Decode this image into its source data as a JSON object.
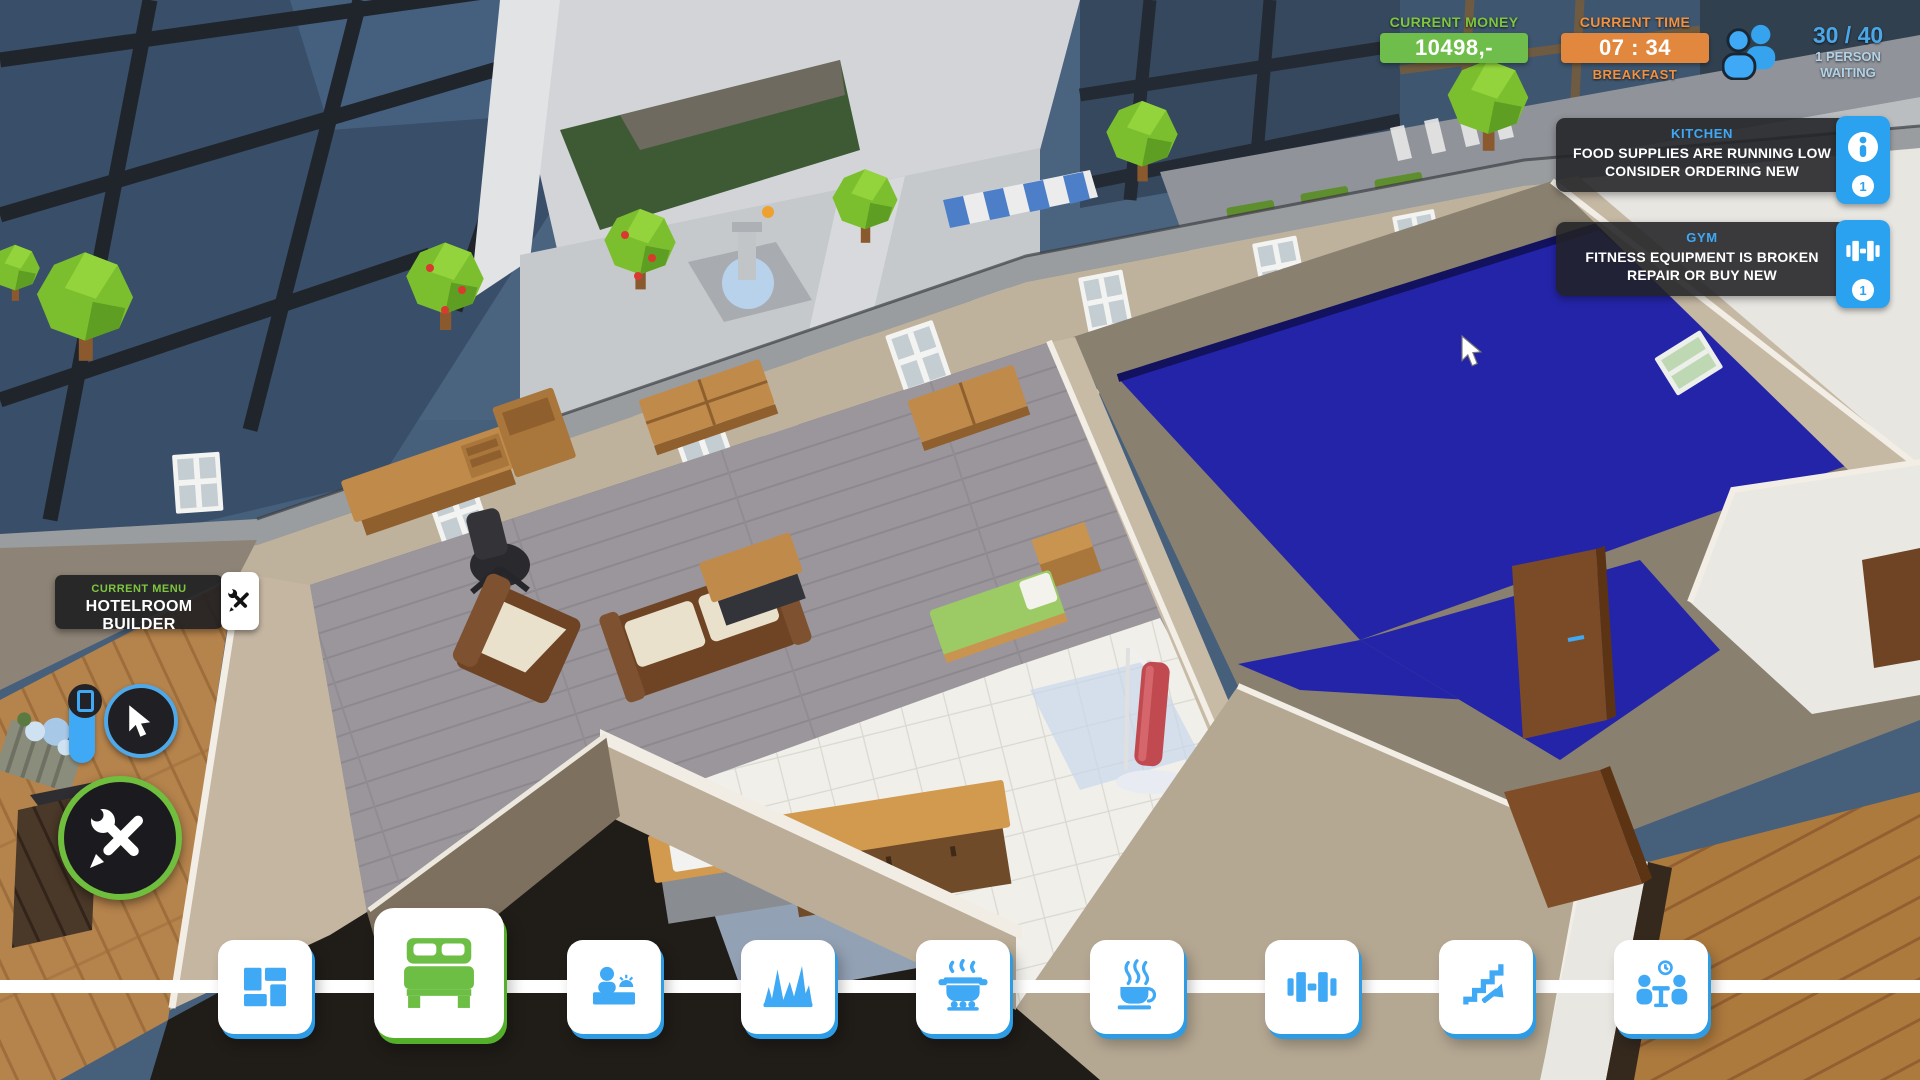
{
  "hud": {
    "money": {
      "label": "CURRENT MONEY",
      "value": "10498,-"
    },
    "time": {
      "label": "CURRENT TIME",
      "value": "07 : 34",
      "period": "BREAKFAST"
    },
    "occupancy": {
      "icon": "people-icon",
      "count": "30 / 40",
      "line1": "1 PERSON",
      "line2": "WAITING"
    }
  },
  "notifications": [
    {
      "category": "KITCHEN",
      "line1": "FOOD SUPPLIES ARE RUNNING LOW",
      "line2": "CONSIDER ORDERING NEW",
      "icon": "info-icon",
      "badge": "1"
    },
    {
      "category": "GYM",
      "line1": "FITNESS EQUIPMENT IS BROKEN",
      "line2": "REPAIR OR BUY NEW",
      "icon": "dumbbell-icon",
      "badge": "1"
    }
  ],
  "current_menu": {
    "label": "CURRENT MENU",
    "value": "HOTELROOM BUILDER",
    "icon": "tools-icon"
  },
  "left_tools": [
    {
      "name": "wall-height-slider",
      "icon": "door-slider-icon"
    },
    {
      "name": "select-tool",
      "icon": "cursor-icon"
    },
    {
      "name": "build-menu",
      "icon": "tools-icon"
    }
  ],
  "toolbar": {
    "items": [
      {
        "name": "floorplan",
        "icon": "floorplan-icon",
        "active": false
      },
      {
        "name": "bedroom",
        "icon": "bed-icon",
        "active": true
      },
      {
        "name": "reception",
        "icon": "reception-icon",
        "active": false
      },
      {
        "name": "garden",
        "icon": "grass-icon",
        "active": false
      },
      {
        "name": "kitchen",
        "icon": "cooking-pot-icon",
        "active": false
      },
      {
        "name": "cafe",
        "icon": "coffee-cup-icon",
        "active": false
      },
      {
        "name": "gym",
        "icon": "dumbbell-icon",
        "active": false
      },
      {
        "name": "stairs",
        "icon": "stairs-icon",
        "active": false
      },
      {
        "name": "restaurant",
        "icon": "diner-table-icon",
        "active": false
      }
    ]
  },
  "colors": {
    "accent_blue": "#3FA9F5",
    "money_green": "#6FBE4B",
    "time_orange": "#E2873E",
    "active_green": "#6DBE45",
    "pool_blue": "#2424A8"
  }
}
